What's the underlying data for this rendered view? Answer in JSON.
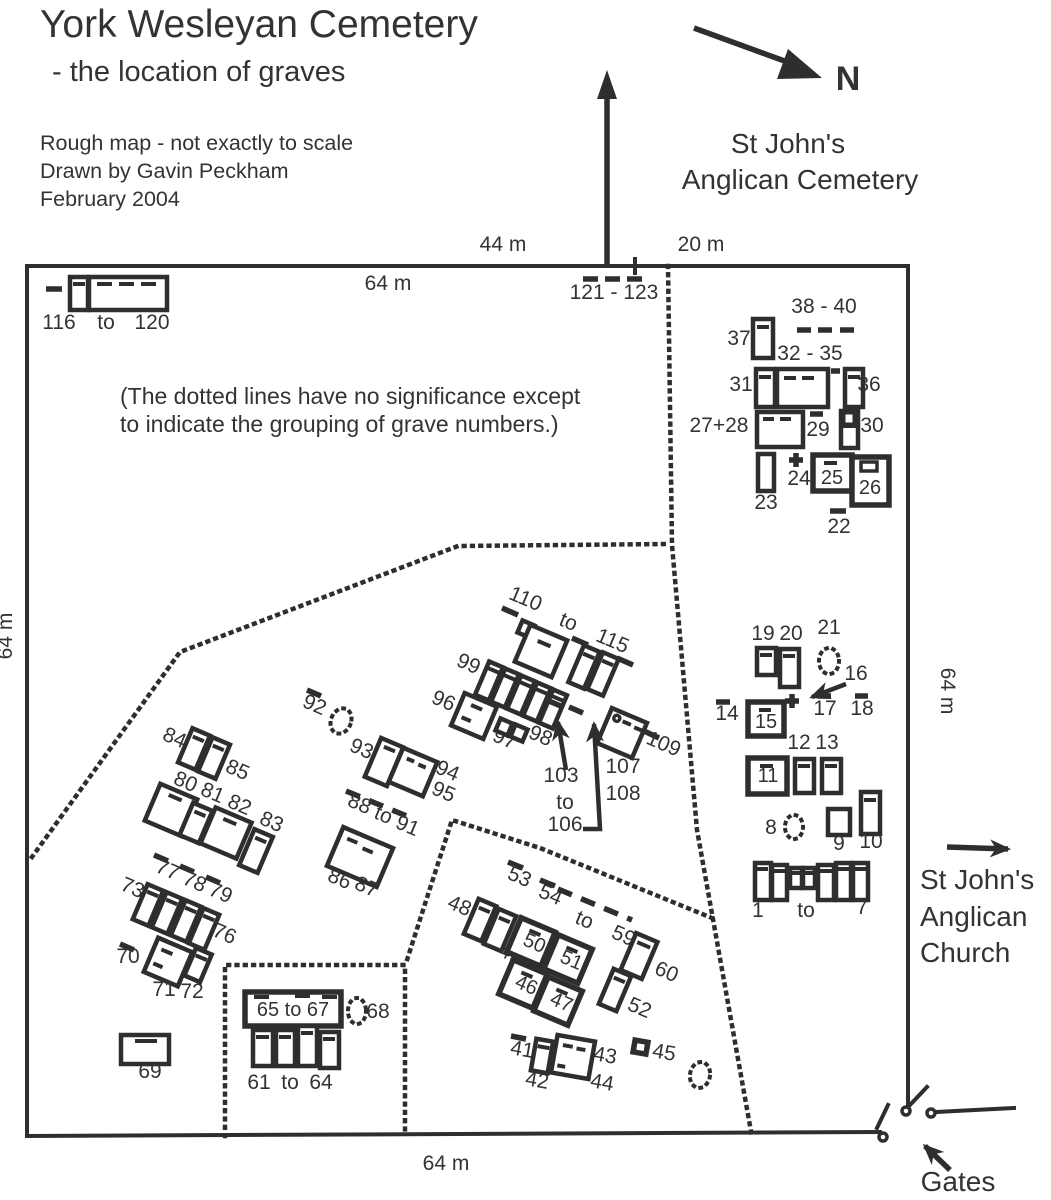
{
  "header": {
    "title": "York Wesleyan Cemetery",
    "subtitle": "- the location of graves",
    "credits": [
      "Rough map - not exactly to scale",
      "Drawn by Gavin Peckham",
      "February 2004"
    ],
    "note1": "(The dotted lines have no significance except",
    "note2": "to indicate the grouping of grave numbers.)"
  },
  "compass": {
    "north": "N"
  },
  "surroundings": {
    "cemetery_line1": "St John's",
    "cemetery_line2": "Anglican Cemetery",
    "church_line1": "St John's",
    "church_line2": "Anglican",
    "church_line3": "Church",
    "gates": "Gates"
  },
  "measurements": {
    "top_west": "44 m",
    "top_east": "20 m",
    "top_inner": "64 m",
    "west": "64 m",
    "east": "64 m",
    "south": "64 m"
  },
  "labels": {
    "to": "to",
    "n116": "116",
    "n120": "120",
    "r121_123": "121 - 123",
    "r38_40": "38 - 40",
    "n37": "37",
    "r32_35": "32 - 35",
    "n31": "31",
    "n36": "36",
    "n27_28": "27+28",
    "n29": "29",
    "n30": "30",
    "n23": "23",
    "n24": "24",
    "n25": "25",
    "n26": "26",
    "n22": "22",
    "n19": "19",
    "n20": "20",
    "n21": "21",
    "n16": "16",
    "n14": "14",
    "n15": "15",
    "n17": "17",
    "n18": "18",
    "n12": "12",
    "n13": "13",
    "n11": "11",
    "n8": "8",
    "n9": "9",
    "n10": "10",
    "n1": "1",
    "n7": "7",
    "n110": "110",
    "n115": "115",
    "n99": "99",
    "n96": "96",
    "n97": "97",
    "n98": "98",
    "n103": "103",
    "n106": "106",
    "n107": "107",
    "n108": "108",
    "n109": "109",
    "n92": "92",
    "n93": "93",
    "n94": "94",
    "n95": "95",
    "n88": "88",
    "n91": "91",
    "n86": "86",
    "n87": "87",
    "n84": "84",
    "n85": "85",
    "n80": "80",
    "n81": "81",
    "n82": "82",
    "n83": "83",
    "n77": "77",
    "n78": "78",
    "n79": "79",
    "n73": "73",
    "n76": "76",
    "n70": "70",
    "n71": "71",
    "n72": "72",
    "n69": "69",
    "r65_67": "65 to 67",
    "n68": "68",
    "n61": "61",
    "n64": "64",
    "n53": "53",
    "n54": "54",
    "n59": "59",
    "n48": "48",
    "n49": "49",
    "n50": "50",
    "n51": "51",
    "n46": "46",
    "n47": "47",
    "n52": "52",
    "n60": "60",
    "n41": "41",
    "n42": "42",
    "n43": "43",
    "n44": "44",
    "n45": "45"
  }
}
